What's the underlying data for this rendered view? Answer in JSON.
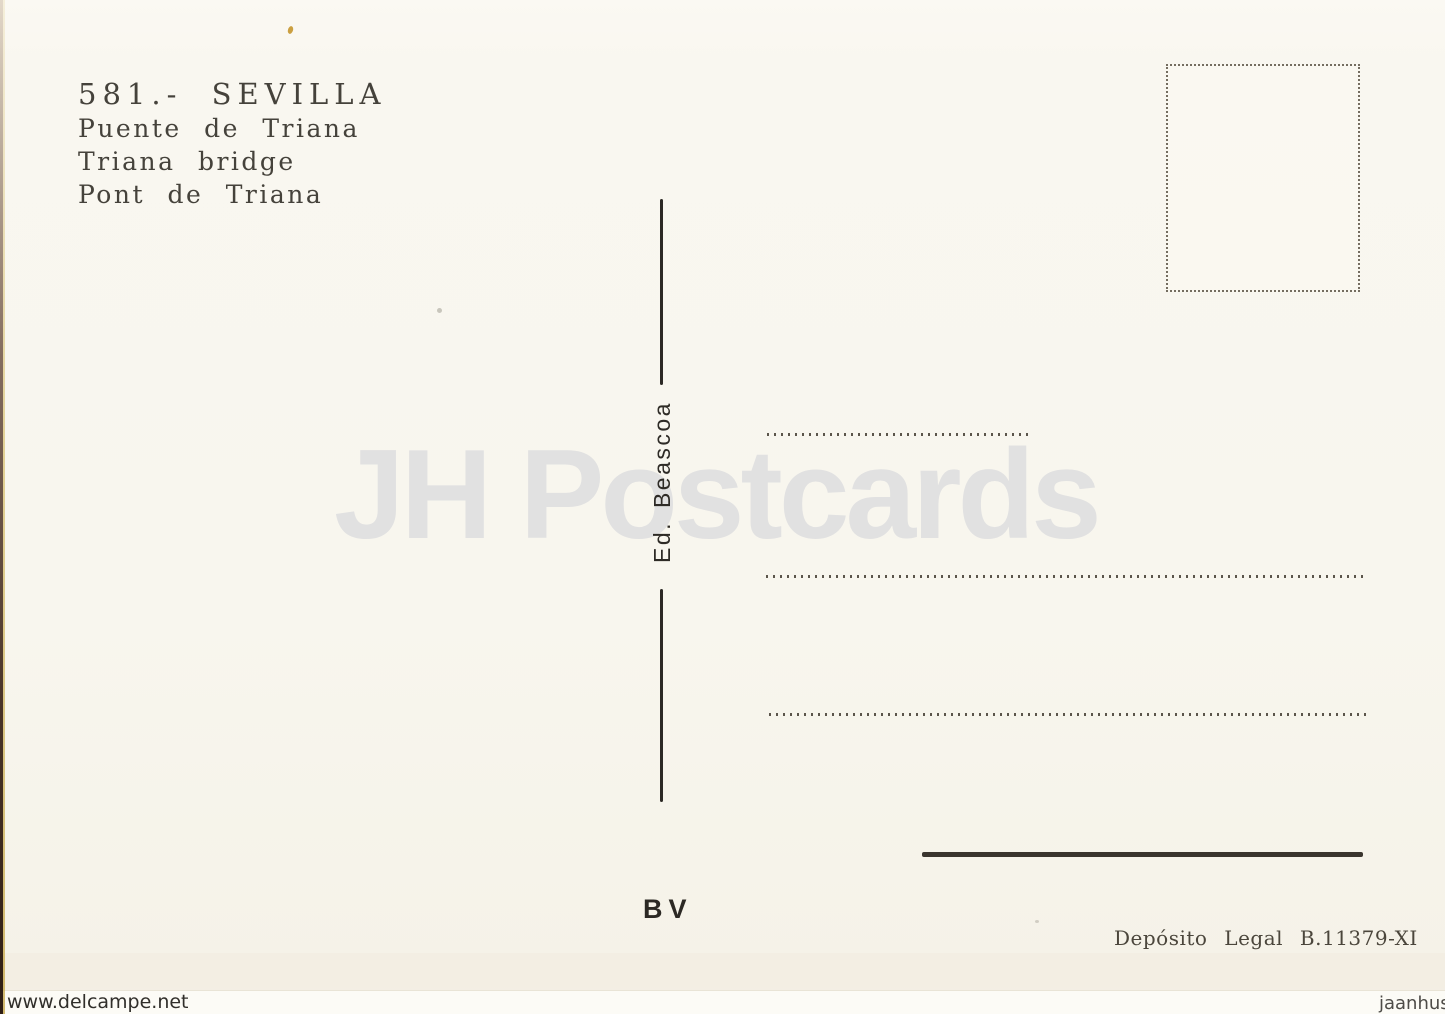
{
  "postcard": {
    "title_block": {
      "title": "581.- SEVILLA",
      "subtitle_es": "Puente de Triana",
      "subtitle_en": "Triana bridge",
      "subtitle_fr": "Pont de Triana"
    },
    "publisher": "Ed. Beascoa",
    "printer_mark": "BV",
    "deposito_legal": "Depósito Legal B.11379-XI"
  },
  "watermarks": {
    "center": "JH Postcards",
    "bottom_left": "www.delcampe.net",
    "bottom_right": "jaanhus"
  },
  "colors": {
    "card_background": "#f8f6ee",
    "ink": "#2c2925",
    "dotted_line": "#5b554b",
    "watermark_gray": "#e1e1e1",
    "scan_edge_dark": "#30180c",
    "scan_edge_gold": "#d0b24b"
  }
}
